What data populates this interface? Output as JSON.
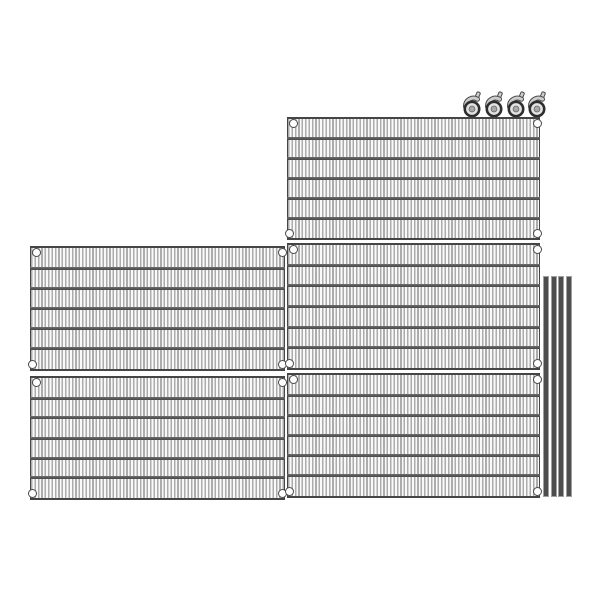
{
  "image": {
    "type": "product-photo",
    "subject": "Disassembled wire shelving unit kit on white background",
    "parts": {
      "wire_shelves": {
        "count": 5,
        "label": "wire shelf panel"
      },
      "swivel_casters": {
        "count": 4,
        "label": "swivel caster wheel"
      },
      "support_poles": {
        "count": 4,
        "label": "support pole"
      }
    }
  },
  "render": {
    "rows_per_shelf": 6,
    "crossbars_per_shelf": 5,
    "corner_collars_per_shelf": 4
  },
  "colors": {
    "background": "#ffffff",
    "wire": "#acacac",
    "wire_gap": "#f9f9f9",
    "shelf_frame": "#454545",
    "crossbar": "#575757",
    "collar_ring": "#4a4a4a",
    "collar_fill": "#ffffff",
    "pole_body": "#4d4d4d",
    "pole_edge": "#a0a0a0",
    "caster_rim": "#2e2e2e",
    "caster_face": "#e3e3e3",
    "caster_hub": "#a9a9a9",
    "caster_fork": "#cdcdcd",
    "caster_outline": "#4a4a4a"
  }
}
